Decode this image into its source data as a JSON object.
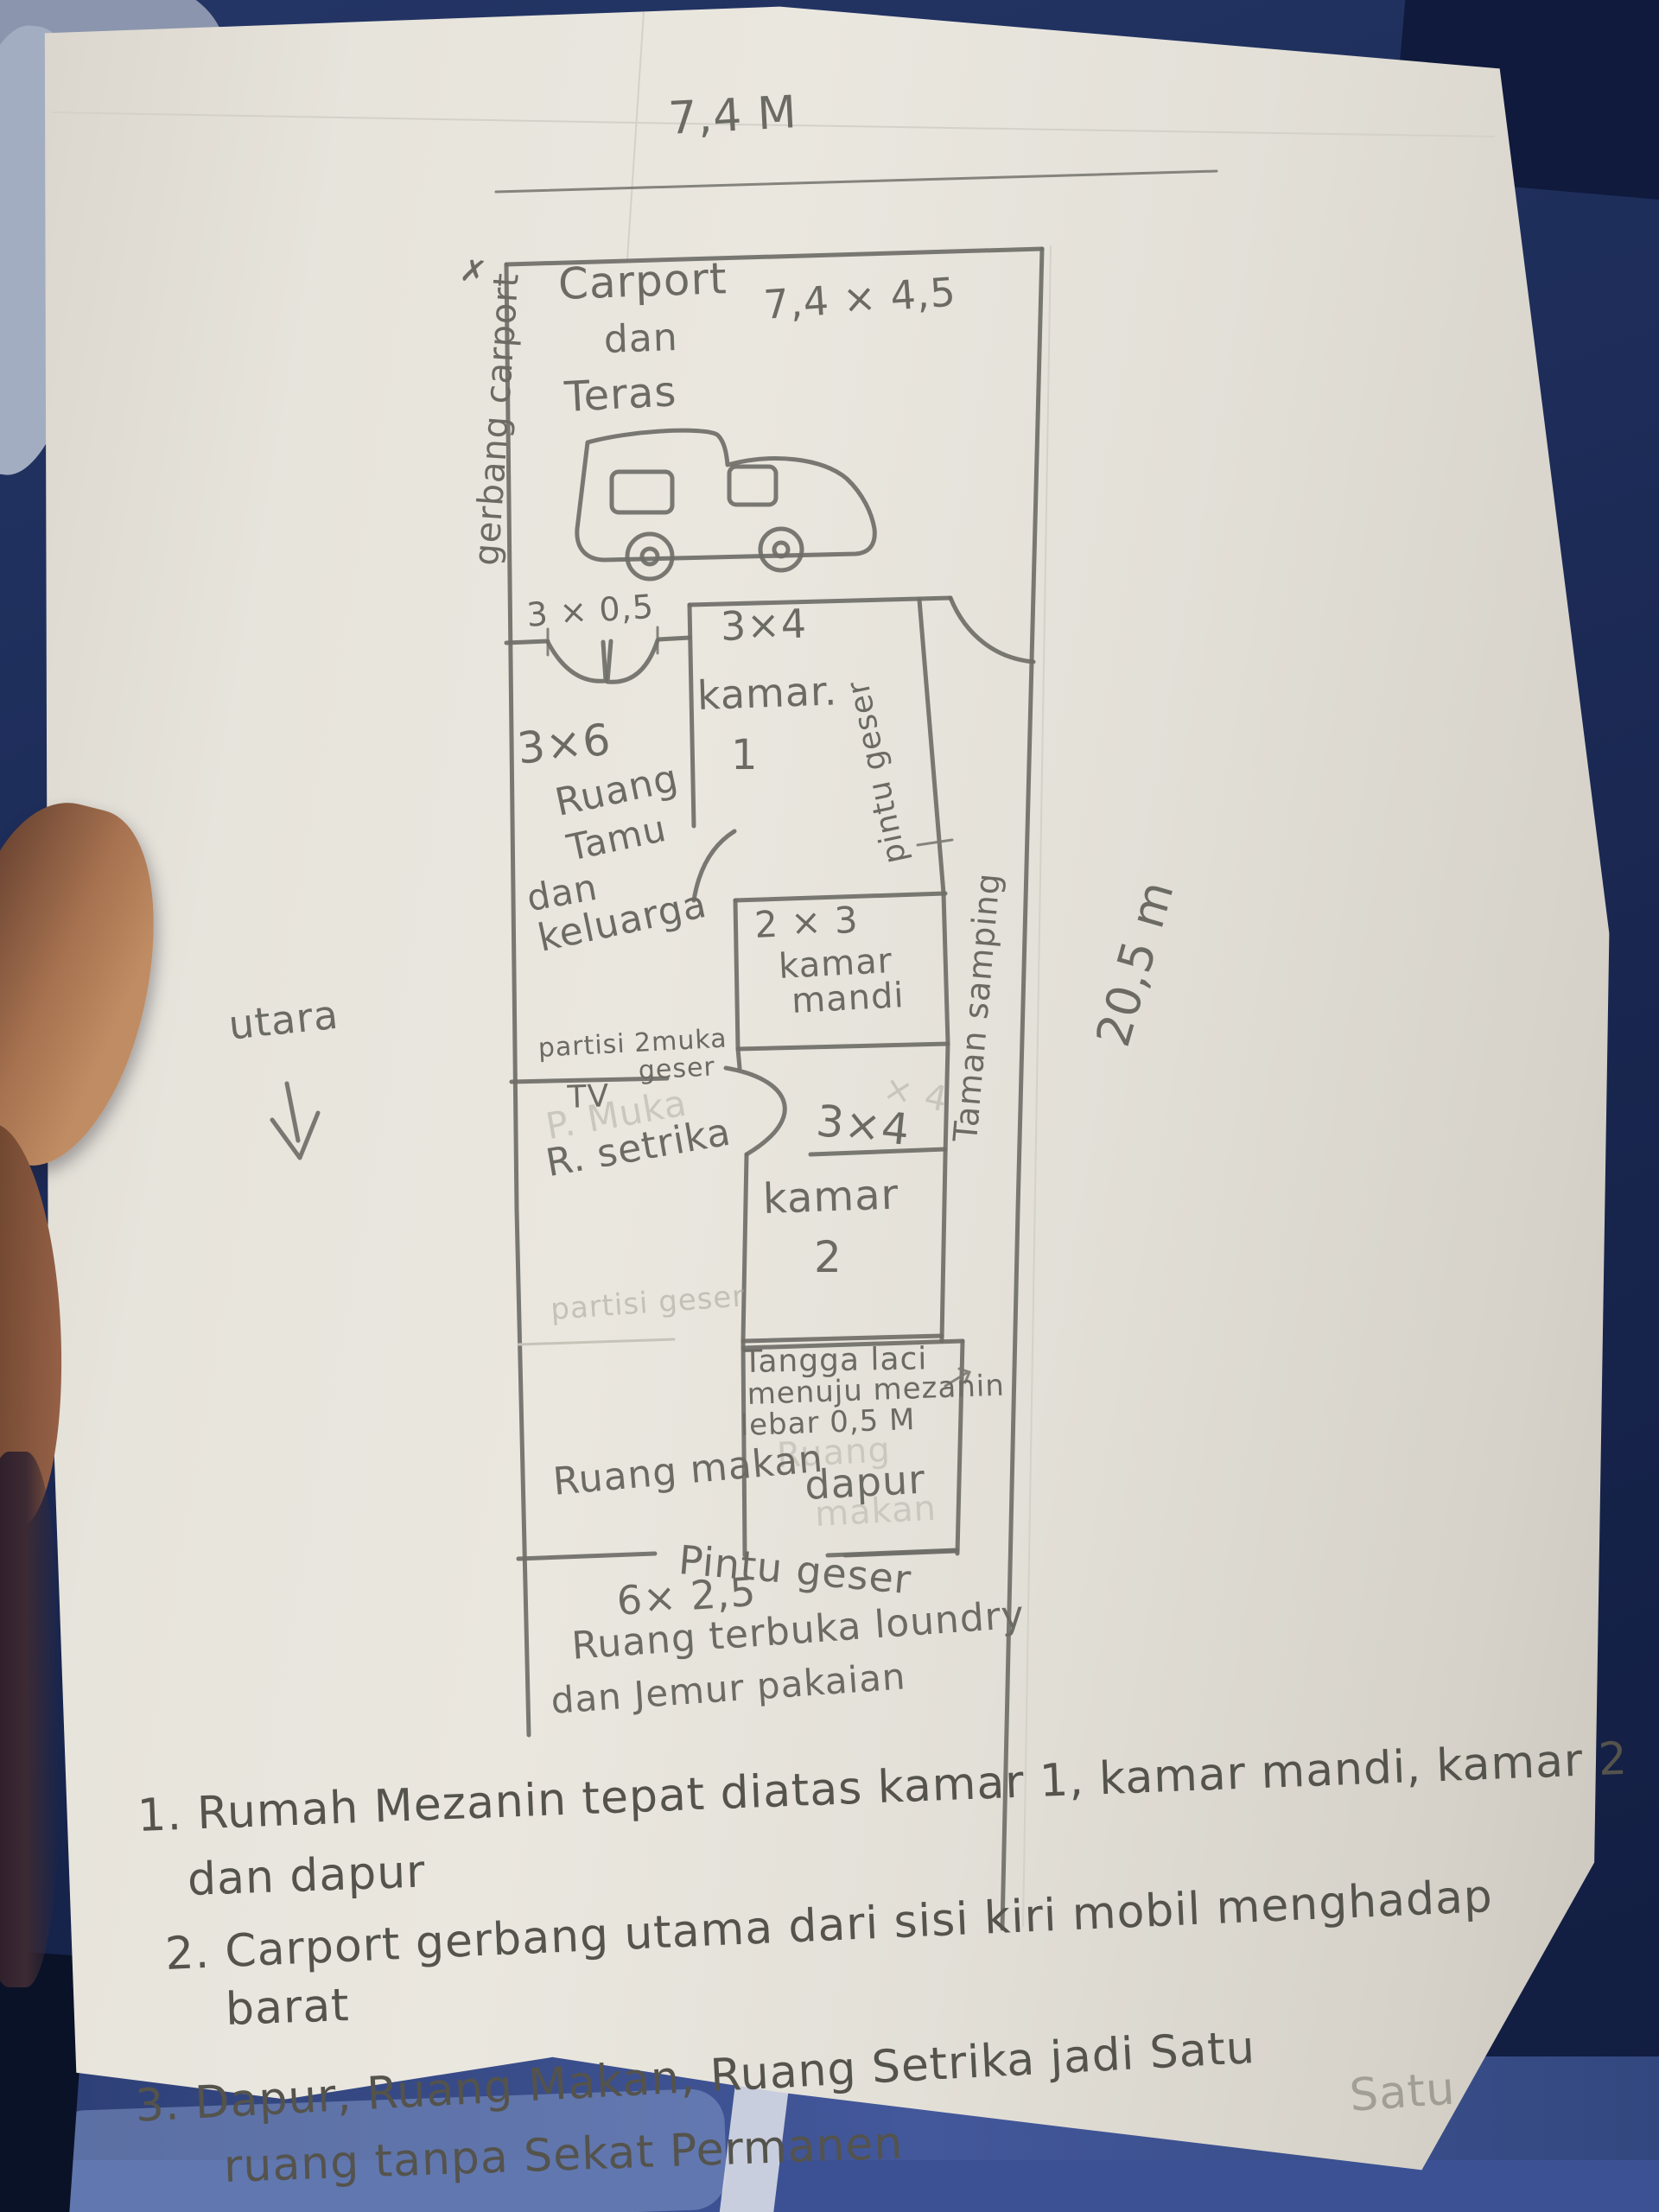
{
  "meta": {
    "description": "Photographed hand-drawn house floor plan sketch on paper (Indonesian), held by a hand over blue fabric"
  },
  "labels": {
    "dim_top": "7,4 M",
    "gate": "gerbang carport",
    "gate_mark": "✗",
    "carport_l1": "Carport",
    "carport_l2": "dan",
    "carport_l3": "Teras",
    "carport_size": "7,4 × 4,5",
    "entry_size": "3 × 0,5",
    "k1_size": "3×4",
    "k1_name": "kamar.",
    "k1_num": "1",
    "pintu_geser_side": "pintu geser",
    "rt_size": "3×6",
    "rt_l1": "Ruang",
    "rt_l2": "Tamu",
    "rt_l3": "dan",
    "rt_l4": "keluarga",
    "km_size": "2 × 3",
    "km_l1": "kamar",
    "km_l2": "mandi",
    "taman": "Taman samping",
    "dim_right": "20,5 m",
    "compass": "utara",
    "partisi_l1": "partisi 2muka",
    "partisi_l2": "geser",
    "tv": "TV",
    "setrika": "R. setrika",
    "k2_size": "3×4",
    "k2_name": "kamar",
    "k2_num": "2",
    "tangga_l1": "Tangga laci",
    "tangga_l2": "menuju mezanin",
    "tangga_l3": "lebar 0,5 M",
    "r_makan": "Ruang makan",
    "dapur": "dapur",
    "pintu_geser_bottom": "Pintu geser",
    "laundry_size": "6× 2,5",
    "laundry_l1": "Ruang terbuka loundry",
    "laundry_l2": "dan Jemur pakaian"
  },
  "ghosts": {
    "p_muka": "P. Muka",
    "partisi_geser": "partisi geser",
    "x4": "× 4",
    "ruang": "Ruang",
    "makan": "makan",
    "satu": "Satu"
  },
  "notes": {
    "n1_l1": "1. Rumah Mezanin tepat diatas kamar 1, kamar mandi, kamar 2",
    "n1_l2": "dan dapur",
    "n2_l1": "2. Carport gerbang utama dari sisi kiri mobil menghadap",
    "n2_l2": "barat",
    "n3_l1": "3. Dapur, Ruang Makan, Ruang Setrika jadi Satu",
    "n3_l2": "ruang tanpa Sekat Permanen"
  },
  "colors": {
    "pencil": "#6c6b63",
    "note_ink": "#54534c",
    "paper": "#e4e1d9",
    "fabric_blue": "#1d2c58",
    "skin": "#a5714f"
  }
}
